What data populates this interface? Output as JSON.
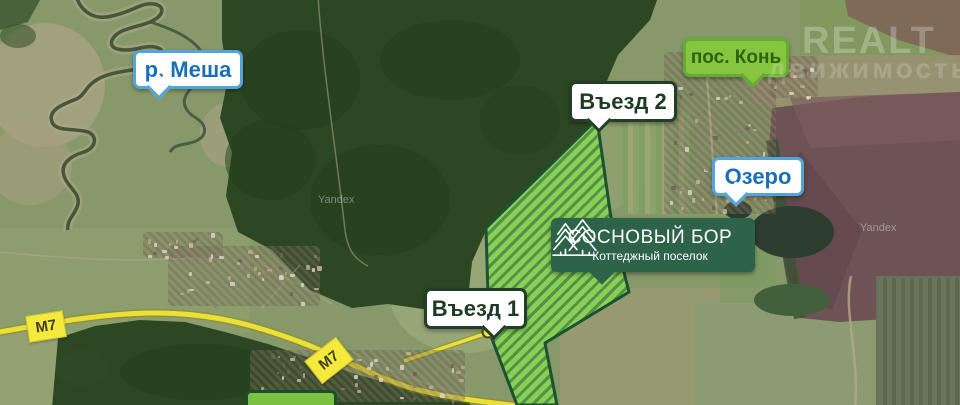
{
  "callouts": {
    "river": {
      "label": "р. Меша",
      "type": "water-label",
      "text_color": "#1a70b8",
      "border_color": "#52a4da"
    },
    "entrance2": {
      "label": "Въезд 2",
      "type": "entrance-label",
      "text_color": "#1f3a25",
      "border_color": "#223d28"
    },
    "settlement": {
      "label": "пос. Конь",
      "type": "settlement-label",
      "text_color": "#2d6310",
      "bg_color": "#87c540"
    },
    "lake": {
      "label": "Озеро",
      "type": "water-label",
      "text_color": "#1a70b8",
      "border_color": "#52a4da"
    },
    "entrance1": {
      "label": "Въезд 1",
      "type": "entrance-label",
      "text_color": "#1f3a25",
      "border_color": "#223d28"
    }
  },
  "brand_badge": {
    "title": "СОСНОВЫЙ БОР",
    "subtitle": "Коттеджный поселок",
    "icon": "pine-trees-icon",
    "bg_color": "#2d6349"
  },
  "road_badges": {
    "m7_west": "М7",
    "m7_south": "М7",
    "bg_color": "#f3ea3d"
  },
  "site_area": {
    "hatch_light": "#8cd156",
    "hatch_dark": "#4a9341",
    "border_color": "#1d5230"
  },
  "watermark": {
    "line1": "REALT",
    "line2": "движимость"
  },
  "map_provider_watermark": "Yandex"
}
